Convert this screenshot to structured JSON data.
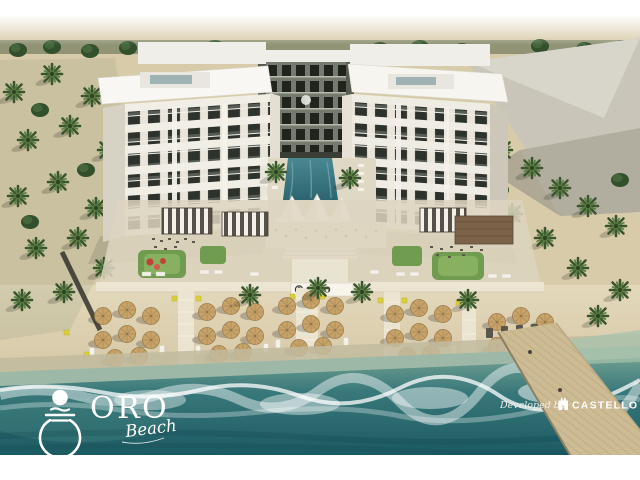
{
  "page": {
    "background": "#ffffff"
  },
  "branding": {
    "logo": {
      "name": "ORO",
      "tagline": "Beach"
    },
    "developer": {
      "prefix": "Developed by",
      "name": "CASTELLO"
    }
  },
  "signage": {
    "entrance_sign": "ORO"
  },
  "palette": {
    "frame_white": "#ffffff",
    "sand": "#d8cbaa",
    "sand_path": "#ece5d2",
    "water_deep": "#1c5a62",
    "water_mid": "#2e6e6f",
    "water_shallow": "#9db8a6",
    "foam_white": "#ffffff",
    "vegetation_green": "#3a5630",
    "building_white": "#f1eee6",
    "umbrella_straw": "#c7a369",
    "pool_teal": "#38727e",
    "pier_wood": "#cdbb94",
    "accent_red": "#c14338",
    "marker_yellow": "#d9cf3e"
  }
}
